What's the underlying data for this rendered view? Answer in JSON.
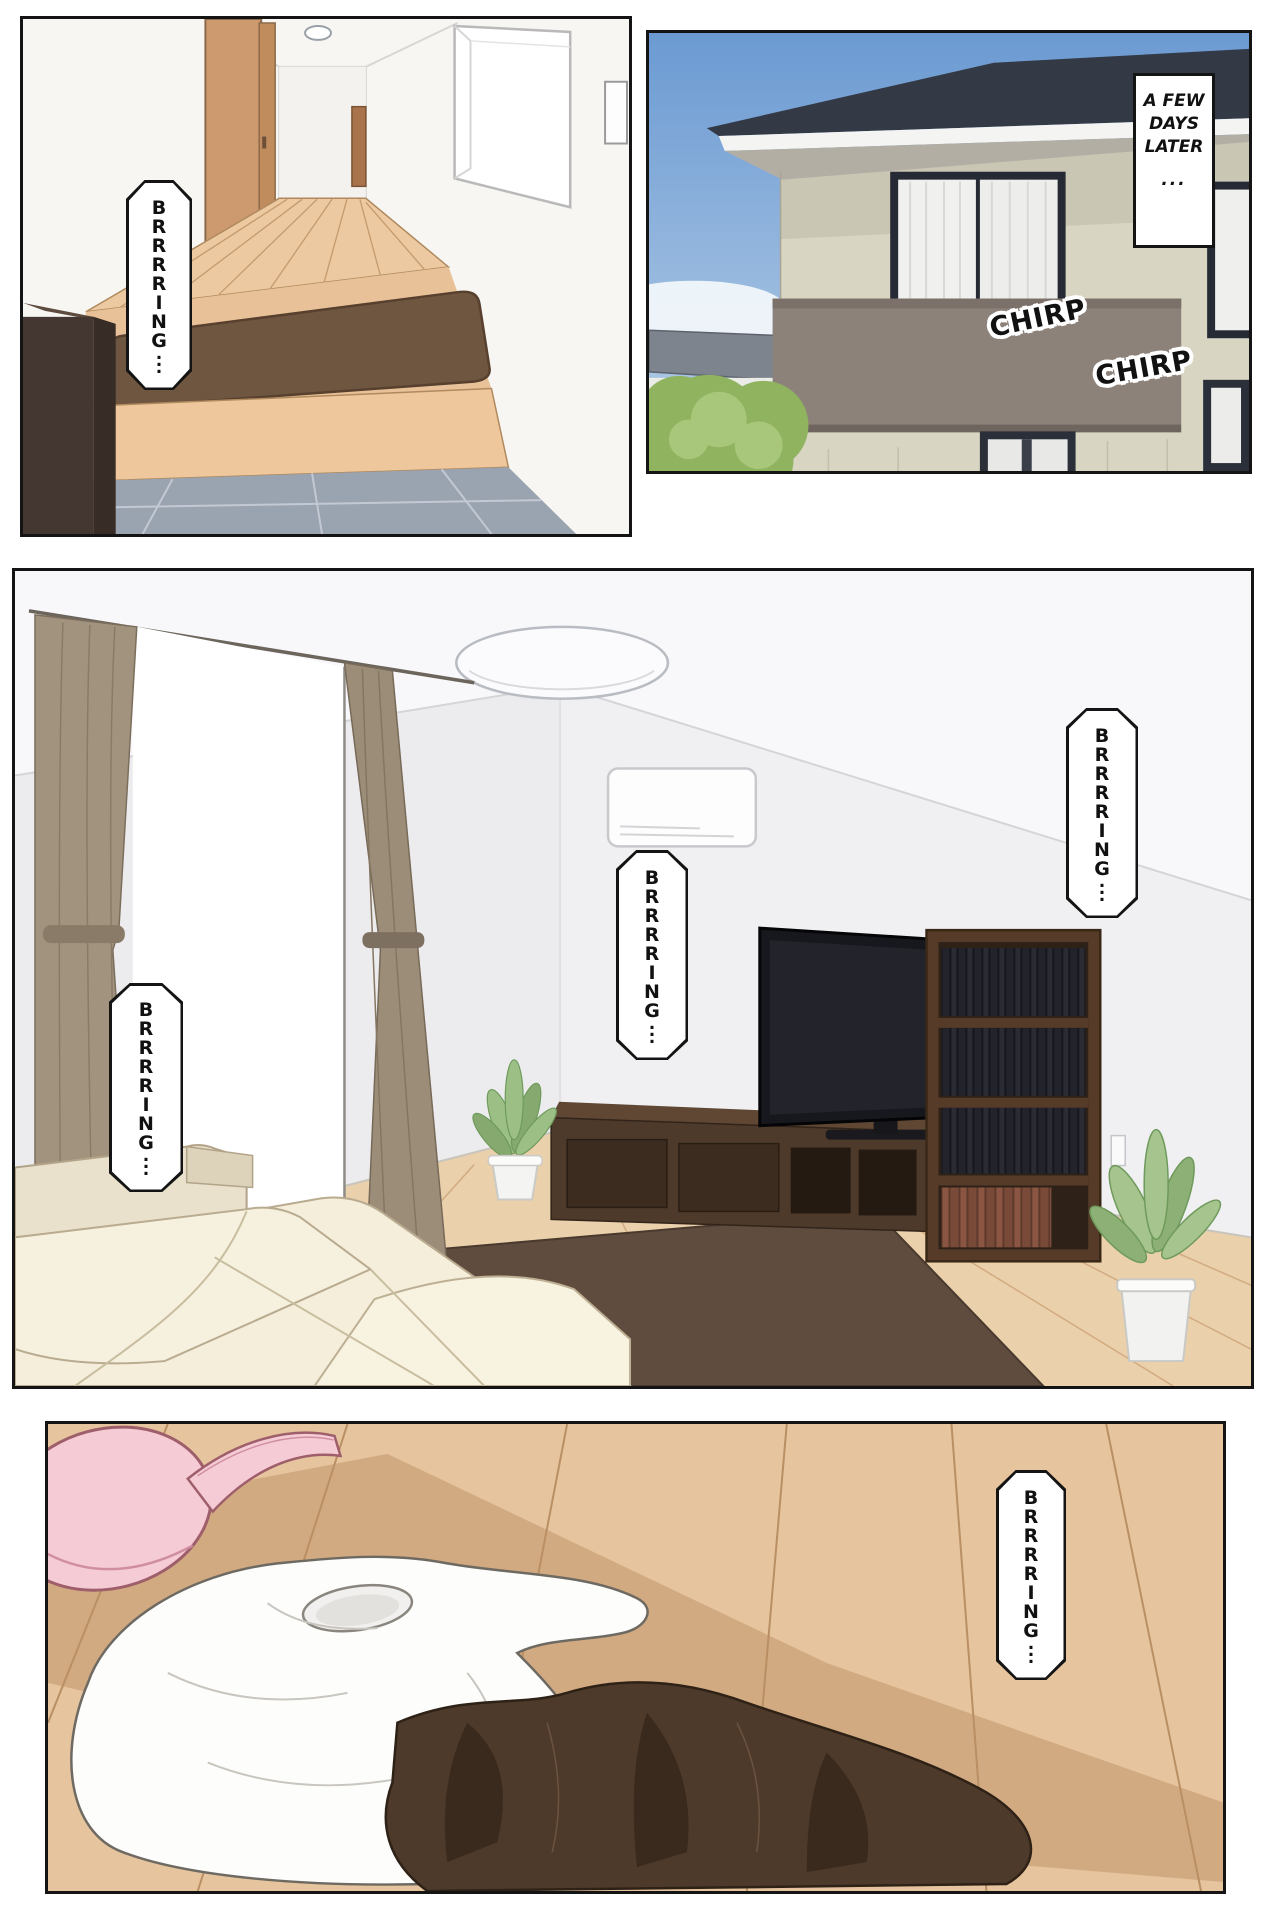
{
  "comic": {
    "panel1": {
      "bubble": "BRRRRING..."
    },
    "panel2": {
      "caption_lines": [
        "A FEW",
        "DAYS",
        "LATER",
        "..."
      ],
      "sfx1": "CHIRP",
      "sfx2": "CHIRP"
    },
    "panel3": {
      "bubble_left": "BRRRRING...",
      "bubble_mid": "BRRRRING...",
      "bubble_right": "BRRRRING..."
    },
    "panel4": {
      "bubble": "BRRRRING..."
    }
  },
  "palette": {
    "panel_border": "#141414",
    "page_background": "#ffffff",
    "hall_floor_wood": "#ecc9a0",
    "genkan_mat_brown": "#6f5640",
    "genkan_tile_gray": "#9aa3b0",
    "shoe_cabinet_brown": "#443631",
    "sky_blue": "#6b9ad2",
    "roof_dark": "#333a46",
    "house_wall_beige": "#c9c6b4",
    "balcony_gray_brown": "#8d827a",
    "tree_green": "#8fb35e",
    "livingroom_wall": "#f0f0f2",
    "livingroom_floor": "#ead0ab",
    "curtain_taupe": "#a2937f",
    "sofa_cream": "#f5efdd",
    "tv_stand_brown": "#4e3a2a",
    "rug_brown": "#5f4c3e",
    "bra_pink": "#f5cbd5",
    "shirt_white": "#fdfdfc",
    "skirt_brown": "#4e3a2b"
  }
}
